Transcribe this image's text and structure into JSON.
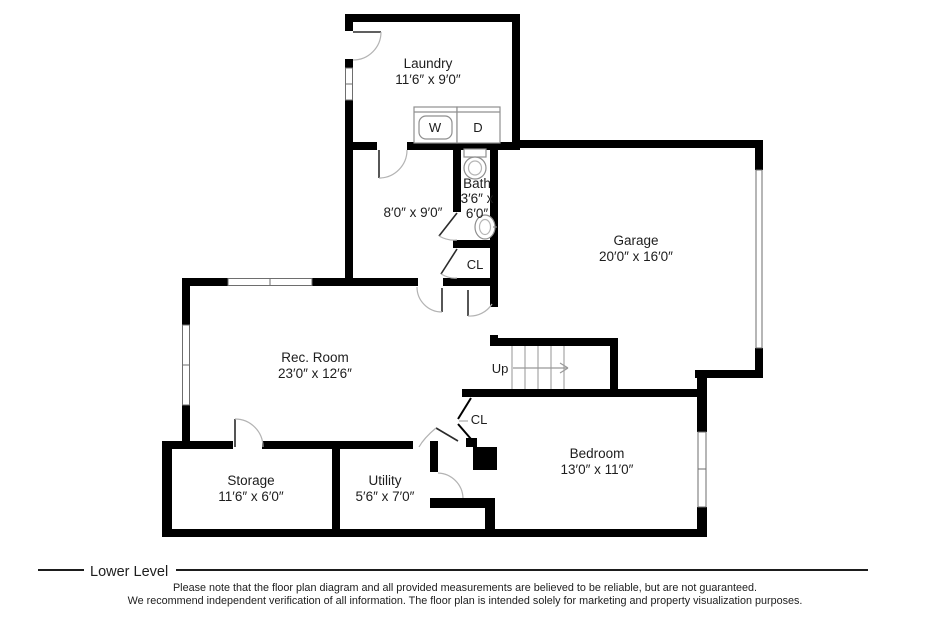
{
  "rooms": {
    "laundry": {
      "name": "Laundry",
      "dims": "11′6″ x 9′0″"
    },
    "hall": {
      "dims": "8′0″ x 9′0″"
    },
    "bath": {
      "name": "Bath",
      "dims_line1": "3′6″ x",
      "dims_line2": "6′0″"
    },
    "bath_closet": {
      "label": "CL"
    },
    "garage": {
      "name": "Garage",
      "dims": "20′0″ x 16′0″"
    },
    "rec_room": {
      "name": "Rec. Room",
      "dims": "23′0″ x 12′6″"
    },
    "stairs": {
      "label": "Up"
    },
    "hall_closet": {
      "label": "CL"
    },
    "bedroom": {
      "name": "Bedroom",
      "dims": "13′0″ x 11′0″"
    },
    "storage": {
      "name": "Storage",
      "dims": "11′6″ x 6′0″"
    },
    "utility": {
      "name": "Utility",
      "dims": "5′6″ x 7′0″"
    }
  },
  "appliances": {
    "washer": "W",
    "dryer": "D"
  },
  "footer": {
    "level_label": "Lower Level",
    "disclaimer_line1": "Please note that the floor plan diagram and all provided measurements are believed to be reliable, but are not guaranteed.",
    "disclaimer_line2": "We recommend independent verification of all information. The floor plan is intended solely for marketing and property visualization purposes."
  },
  "colors": {
    "wall": "#000000",
    "text": "#1d1d1d",
    "door_arc": "#b3b3b3",
    "fixture_stroke": "#8f8f8f",
    "stair_tread": "#a6a6a6"
  }
}
